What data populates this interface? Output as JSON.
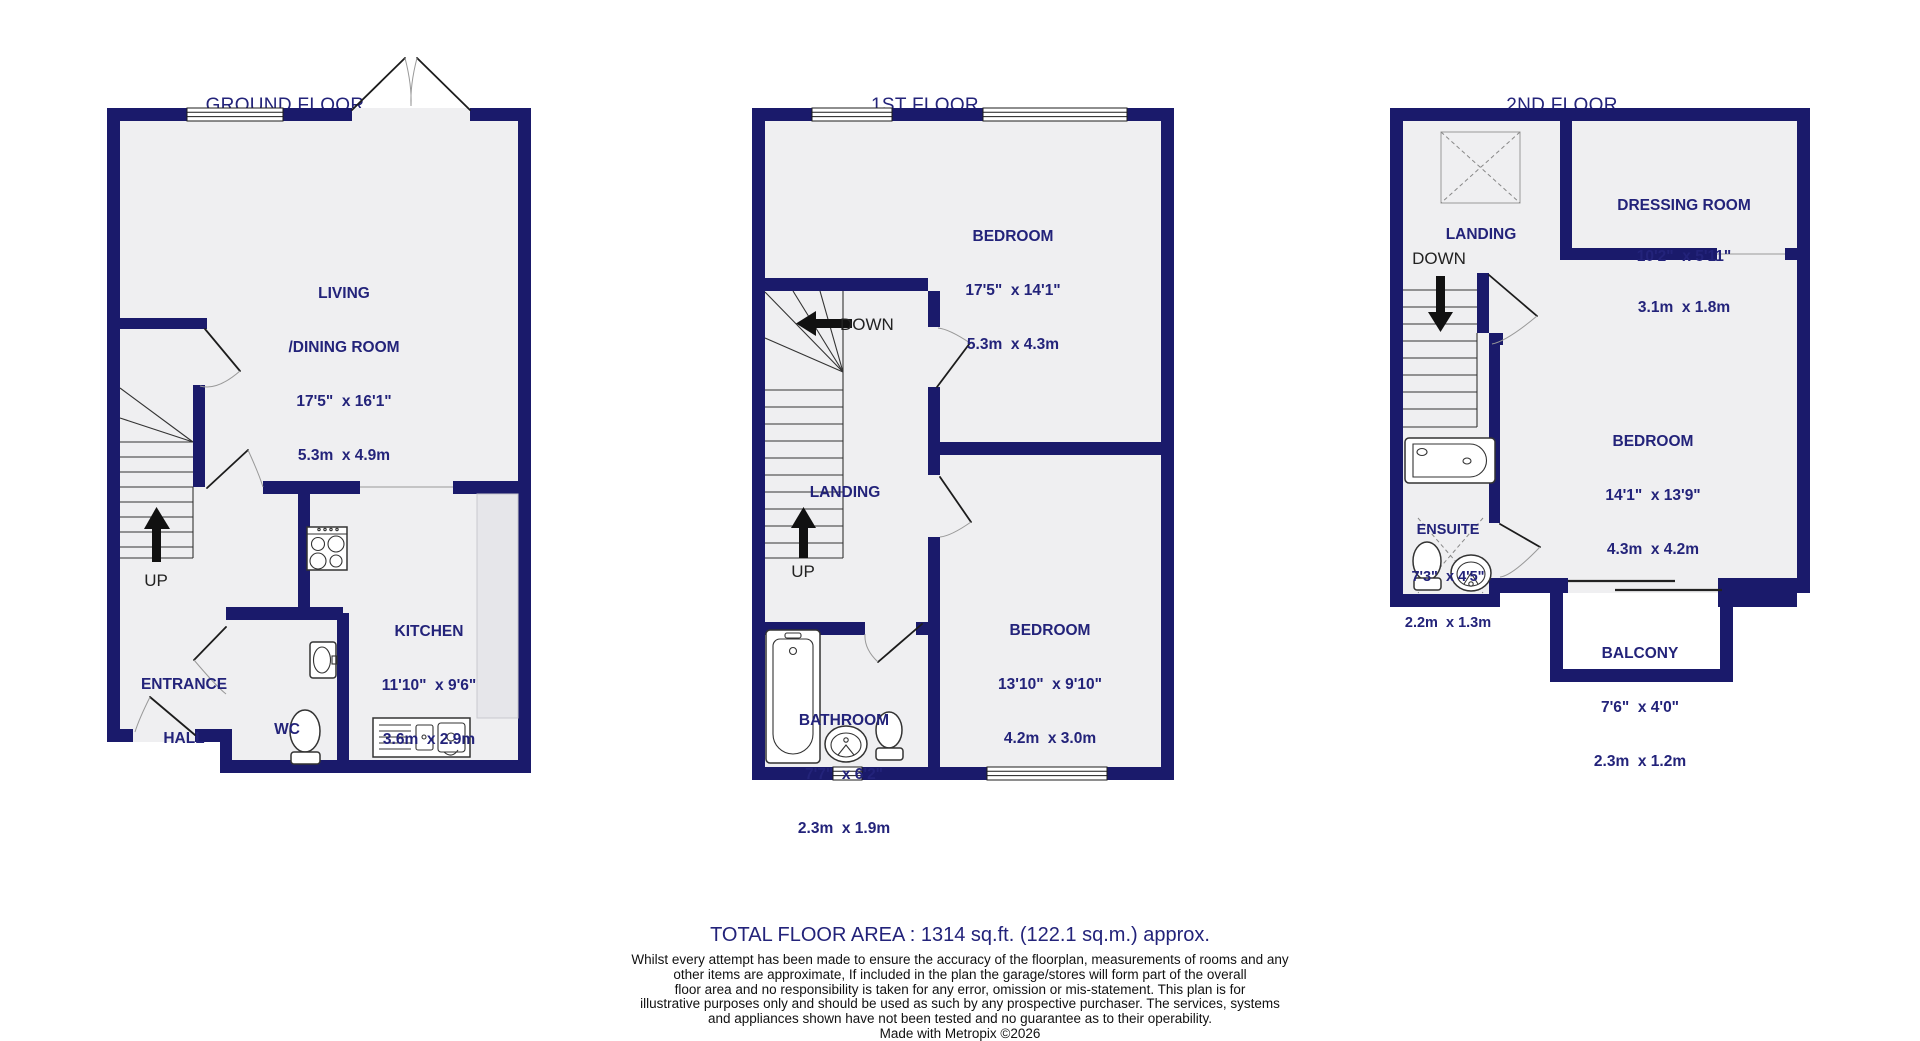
{
  "colors": {
    "wall": "#1a1a6b",
    "floor": "#efeff1",
    "text": "#23237a",
    "counter": "#e6e6ea"
  },
  "floors": [
    {
      "title": "GROUND FLOOR",
      "subtitle": "478 sq.ft. (44.5 sq.m.) approx.",
      "rooms": {
        "living": {
          "line1": "LIVING",
          "line2": "/DINING ROOM",
          "dims_ft": "17'5\"  x 16'1\"",
          "dims_m": "5.3m  x 4.9m"
        },
        "kitchen": {
          "line1": "KITCHEN",
          "dims_ft": "11'10\"  x 9'6\"",
          "dims_m": "3.6m  x 2.9m"
        },
        "hall": {
          "line1": "ENTRANCE",
          "line2": "HALL"
        },
        "wc": {
          "line1": "WC"
        }
      },
      "labels": {
        "up": "UP"
      }
    },
    {
      "title": "1ST FLOOR",
      "subtitle": "485 sq.ft. (45.1 sq.m.) approx.",
      "rooms": {
        "bedroom1": {
          "line1": "BEDROOM",
          "dims_ft": "17'5\"  x 14'1\"",
          "dims_m": "5.3m  x 4.3m"
        },
        "bedroom2": {
          "line1": "BEDROOM",
          "dims_ft": "13'10\"  x 9'10\"",
          "dims_m": "4.2m  x 3.0m"
        },
        "bathroom": {
          "line1": "BATHROOM",
          "dims_ft": "7'7\"  x 6'2\"",
          "dims_m": "2.3m  x 1.9m"
        },
        "landing": {
          "line1": "LANDING"
        }
      },
      "labels": {
        "up": "UP",
        "down": "DOWN"
      }
    },
    {
      "title": "2ND FLOOR",
      "subtitle": "350 sq.ft. (32.5 sq.m.) approx.",
      "rooms": {
        "landing": {
          "line1": "LANDING"
        },
        "dressing": {
          "line1": "DRESSING ROOM",
          "dims_ft": "10'2\"  x 5'11\"",
          "dims_m": "3.1m  x 1.8m"
        },
        "bedroom": {
          "line1": "BEDROOM",
          "dims_ft": "14'1\"  x 13'9\"",
          "dims_m": "4.3m  x 4.2m"
        },
        "ensuite": {
          "line1": "ENSUITE",
          "dims_ft": "7'3\"  x 4'5\"",
          "dims_m": "2.2m  x 1.3m"
        },
        "balcony": {
          "line1": "BALCONY",
          "dims_ft": "7'6\"  x 4'0\"",
          "dims_m": "2.3m  x 1.2m"
        }
      },
      "labels": {
        "down": "DOWN"
      }
    }
  ],
  "footer": {
    "total": "TOTAL FLOOR AREA : 1314 sq.ft. (122.1 sq.m.) approx.",
    "disclaimer_lines": [
      "Whilst every attempt has been made to ensure the accuracy of the floorplan, measurements of rooms and any",
      "other items are approximate, If included in the plan the garage/stores will form part of the overall",
      "floor area and no responsibility is taken for any error, omission or mis-statement. This plan is for",
      "illustrative purposes only and should be used as such by any prospective purchaser. The services, systems",
      "and appliances shown have not been tested and no guarantee as to their operability."
    ],
    "credit": "Made with Metropix ©2026"
  }
}
